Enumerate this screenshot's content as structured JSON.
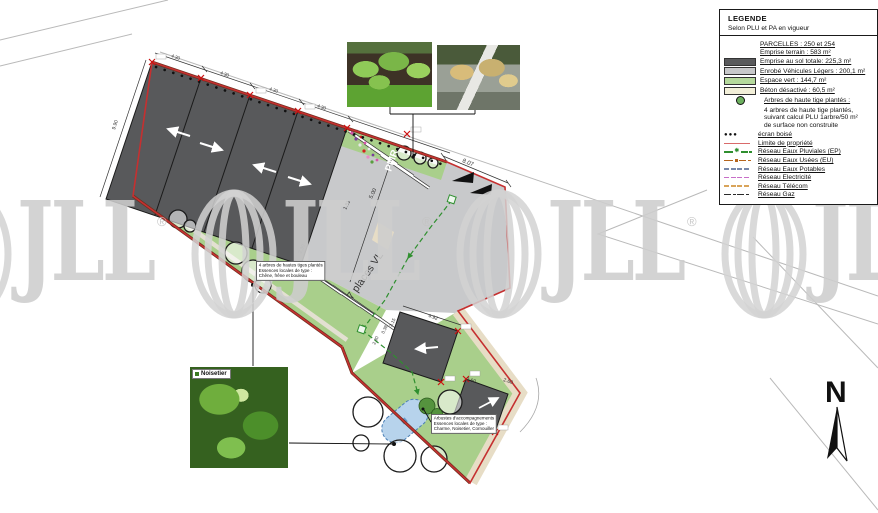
{
  "watermark": {
    "text": "JLL",
    "reg": "®",
    "color": "#d2d2d2"
  },
  "north_label": "N",
  "legend": {
    "title": "LEGENDE",
    "subtitle": "Selon PLU et PA en vigueur",
    "items": [
      {
        "label": "PARCELLES : 250 et 254"
      },
      {
        "label": "Emprise terrain : 583 m²"
      },
      {
        "label": "Emprise au sol totale: 225,3 m²",
        "color": "#595a5c"
      },
      {
        "label": "Enrobé Véhicules Légers : 200,1 m²",
        "color": "#c7c8ca"
      },
      {
        "label": "Espace vert : 144,7 m²",
        "color": "#b5d99c"
      },
      {
        "label": "Béton désactivé : 60,5 m²",
        "color": "#f2efd8"
      },
      {
        "label": "Arbres de haute tige plantés :",
        "color": "#6db05f",
        "sub": [
          "4 arbres de haute tige plantés,",
          "suivant calcul PLU 1arbre/50 m²",
          "de surface non construite"
        ]
      },
      {
        "label": "écran boisé",
        "dots": "●●●"
      },
      {
        "label": "Limite de propriété",
        "color": "#d96a6a"
      },
      {
        "label": "Réseau Eaux Pluviales (EP)",
        "color": "#2f8f2f",
        "marker": "✱"
      },
      {
        "label": "Réseau Eaux Usées (EU)",
        "color": "#b5651d"
      },
      {
        "label": "Réseau Eaux Potables",
        "color": "#7788aa"
      },
      {
        "label": "Réseau Electricité",
        "color": "#c86ec8"
      },
      {
        "label": "Réseau Télécom",
        "color": "#d9a45a"
      },
      {
        "label": "Réseau Gaz",
        "color": "#2a2a2a"
      }
    ]
  },
  "plan": {
    "labels": {
      "pmr": "PMR",
      "places_vl": "7 places VL"
    },
    "dims": {
      "top_right": "8.07",
      "aisle_a": "5.00",
      "aisle_b": "1.81",
      "aisle_c": "2.30",
      "left_edge": "9.90",
      "bays": [
        "4.30",
        "4.30",
        "4.30",
        "4.30"
      ],
      "b2_ne": "4.92",
      "b2_a": "3.15",
      "b2_b": "0.38",
      "b2_c": "2.30",
      "b3_a": "2.60",
      "b3_b": "2.60"
    },
    "notes": {
      "trees": [
        "4 arbres de hautes tiges plantés",
        "Essences locales de type :",
        "Chêne, frêne et bouleau"
      ],
      "shrubs": [
        "Arbustes d'accompagnements",
        "Essences locales de type :",
        "Charme, Noisetier, Cornouiller"
      ]
    },
    "photo_label": "Noisetier"
  },
  "colors": {
    "building": "#58595b",
    "parking": "#c8c9cb",
    "green": "#a9cf8b",
    "beige": "#e7ddc6",
    "boundary_red": "#c53030",
    "hedge": "#6e2e1e",
    "ep_green": "#2f8f2f",
    "pond_fill": "#b7d3ec",
    "pond_stroke": "#4a7fb5"
  }
}
